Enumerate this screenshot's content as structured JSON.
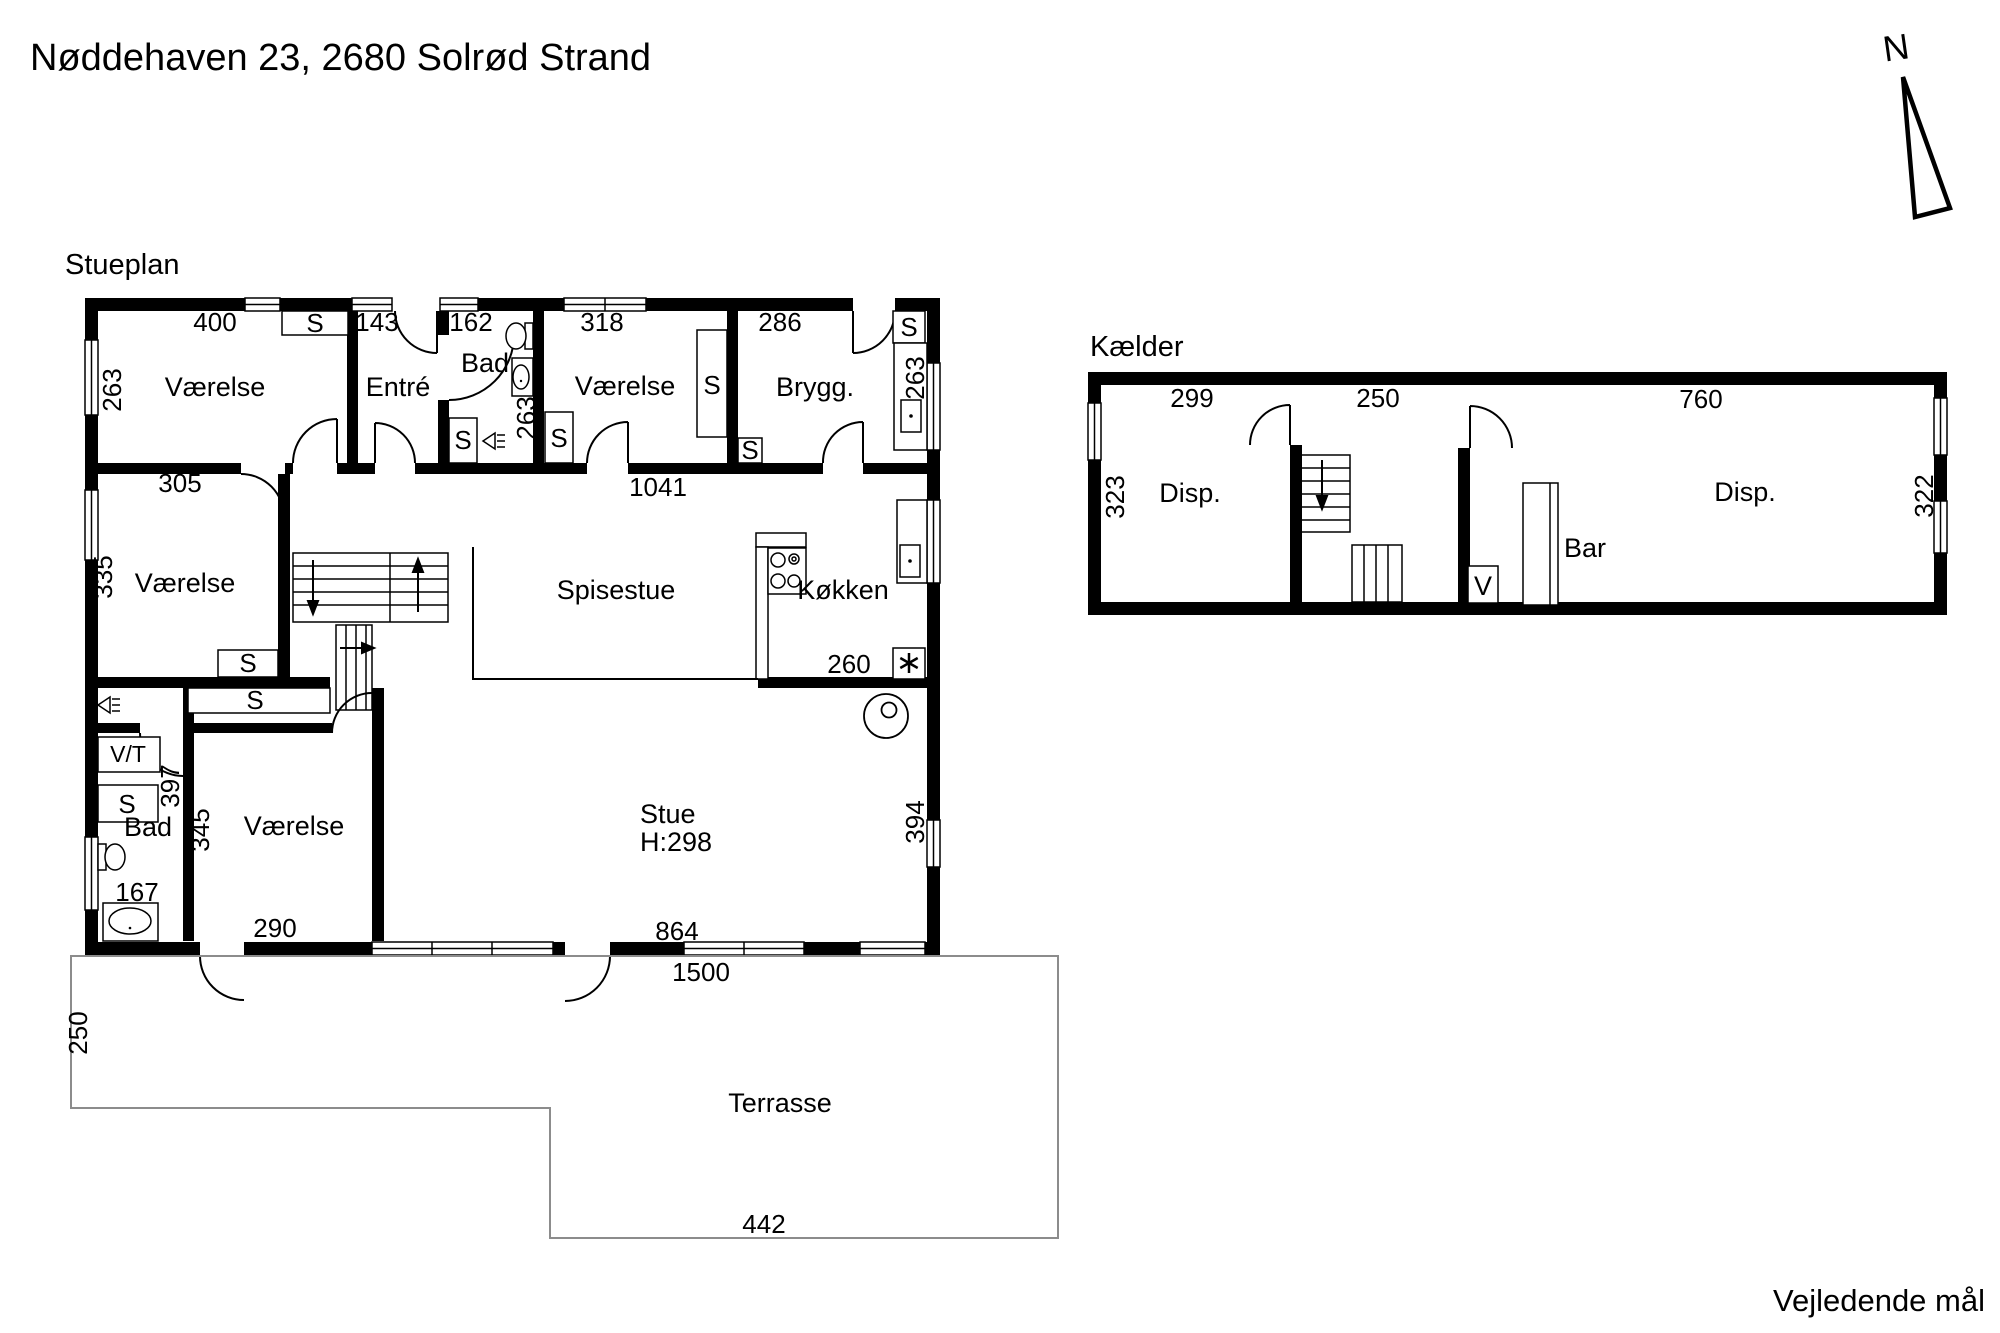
{
  "title": "Nøddehaven 23, 2680 Solrød Strand",
  "footnote": "Vejledende mål",
  "north_label": "N",
  "stueplan": {
    "title": "Stueplan",
    "rooms": {
      "vaerelse": "Værelse",
      "entre": "Entré",
      "bad": "Bad",
      "brygg": "Brygg.",
      "spisestue": "Spisestue",
      "koekken": "Køkken",
      "stue": "Stue",
      "stue_height": "H:298",
      "terrasse": "Terrasse"
    },
    "labels": {
      "closet": "S",
      "washer_dryer": "V/T"
    },
    "dims": {
      "d400": "400",
      "d143": "143",
      "d162": "162",
      "d318": "318",
      "d286": "286",
      "d263": "263",
      "d305": "305",
      "d1041": "1041",
      "d335": "335",
      "d260": "260",
      "d397": "397",
      "d345": "345",
      "d167": "167",
      "d290": "290",
      "d864": "864",
      "d394": "394",
      "d1500": "1500",
      "d250": "250",
      "d442": "442"
    }
  },
  "kaelder": {
    "title": "Kælder",
    "rooms": {
      "disp": "Disp.",
      "bar": "Bar",
      "vent": "V"
    },
    "dims": {
      "d299": "299",
      "d250": "250",
      "d760": "760",
      "d323": "323",
      "d322": "322"
    }
  }
}
